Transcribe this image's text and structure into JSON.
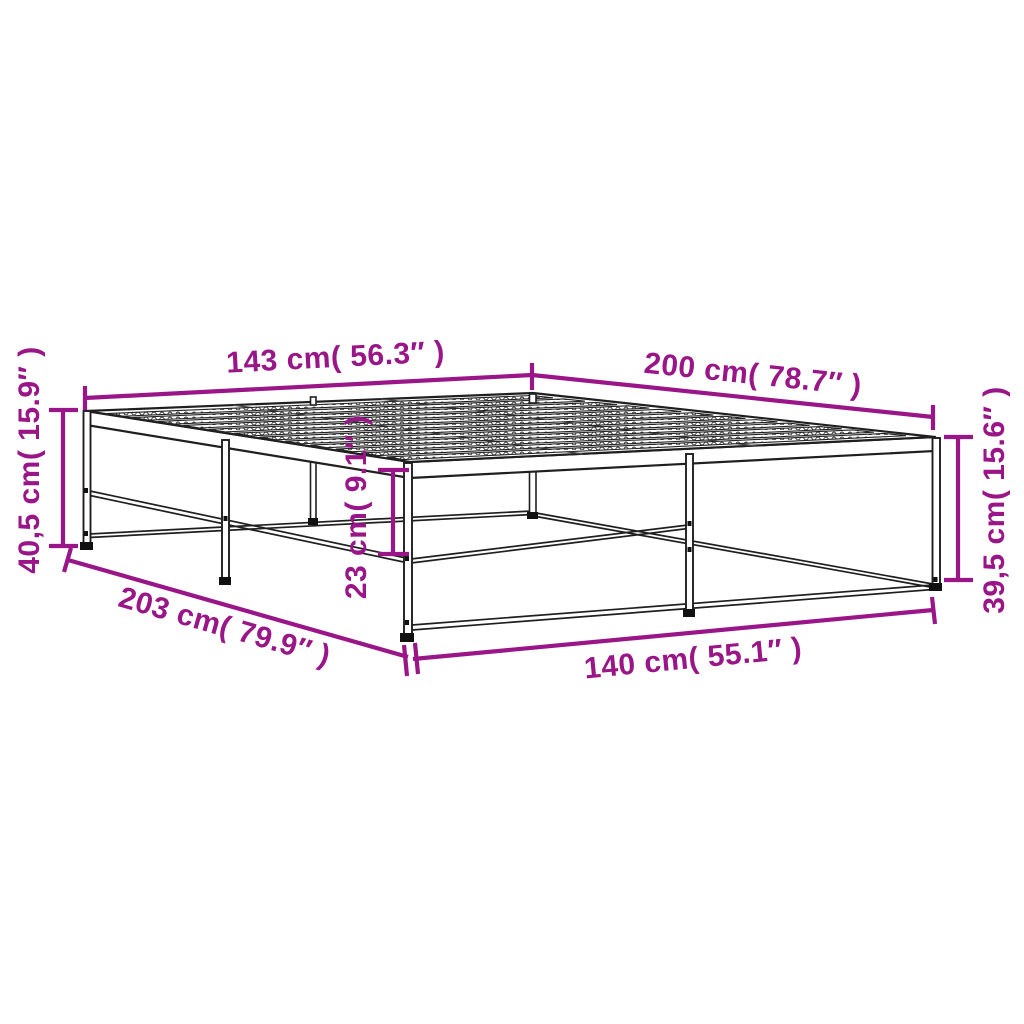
{
  "diagram": {
    "subject": "metal-bed-frame-dimension-drawing",
    "background_color": "#ffffff",
    "accent_color": "#9A1688",
    "line_color": "#1f1f1f",
    "dimensions": {
      "width_top": "143 cm( 56.3″ )",
      "length_top": "200 cm( 78.7″ )",
      "height_left": "40,5 cm( 15.9″ )",
      "height_right": "39,5 cm( 15.6″ )",
      "clearance_under": "23 cm( 9.1″ )",
      "length_bottom": "203 cm( 79.9″ )",
      "width_bottom": "140 cm( 55.1″ )"
    }
  }
}
